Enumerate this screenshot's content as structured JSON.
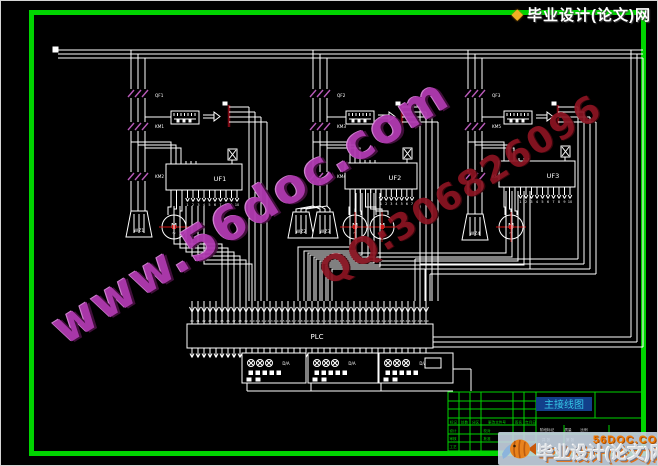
{
  "watermark": {
    "site": "www.56doc.com",
    "qq": "QQ:306826096"
  },
  "top_logo": {
    "icon_glyph": "◆",
    "text": "毕业设计(论文)网"
  },
  "bottom_logo": {
    "site": "56DOC.COM",
    "name": "毕业设计(论文)网"
  },
  "title_block": {
    "title": "主接线图",
    "revision_labels": [
      "标记",
      "处数",
      "分区",
      "更改文件号",
      "签名",
      "年月日"
    ],
    "role_labels_col1": [
      "设计",
      "审核",
      "工艺"
    ],
    "role_labels_col2": [
      "校对",
      "批准"
    ],
    "stage_labels": [
      "阶段标记",
      "质量",
      "比例"
    ],
    "sheet_labels": [
      "共 张",
      "第 张"
    ]
  },
  "schematic": {
    "plc_label": "PLC",
    "input_prefix": "X",
    "output_prefix": "Y",
    "branches": [
      {
        "breaker": "QF1",
        "contactors": [
          "KM1",
          "KM2"
        ],
        "inverter": "UF1",
        "resistors": [
          "WZ1"
        ],
        "motor_label": "M"
      },
      {
        "breaker": "QF2",
        "contactors": [
          "KM3",
          "KM4"
        ],
        "inverter": "UF2",
        "resistors": [
          "WZ2",
          "WZ3"
        ],
        "motor_label": "M"
      },
      {
        "breaker": "QF3",
        "contactors": [
          "KM5",
          "KM6"
        ],
        "inverter": "UF3",
        "resistors": [
          "WZ4"
        ],
        "motor_label": "M"
      }
    ],
    "module_labels": [
      "D/A",
      "D/A",
      "D/A"
    ],
    "colors": {
      "wire": "#ffffff",
      "device": "#b85ab8",
      "accent_red": "#cc1111",
      "dark_red": "#7a0a14",
      "frame_green": "#00d400",
      "title_cyan": "#35c8e8",
      "title_highlight": "#123f8a"
    }
  }
}
